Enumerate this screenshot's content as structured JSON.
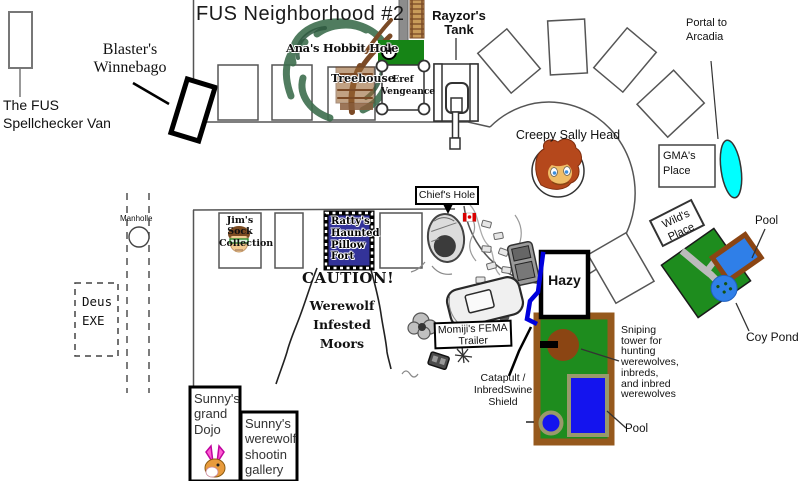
{
  "title": "FUS Neighborhood #2",
  "labels": {
    "spellchecker_van": "The FUS\nSpellchecker Van",
    "blasters_winnebago": "Blaster's\nWinnebago",
    "anas_hobbit_hole": "Ana's Hobbit Hole",
    "treehouse": "Treehouse",
    "helipad_h": "H",
    "eref_vengeance": "Eref\nVengeance",
    "rayzors_tank": "Rayzor's\nTank",
    "portal_to_arcadia": "Portal to\nArcadia",
    "creepy_sally_head": "Creepy Sally Head",
    "gmas_place": "GMA's\nPlace",
    "wilds_place": "Wild's\nPlace",
    "pool_upper": "Pool",
    "coy_pond": "Coy Pond",
    "manholle": "Manholle",
    "deus_exe": "Deus\nEXE",
    "jims_sock_collection": "Jim's Sock\nCollection",
    "rattys_pillow_fort": "Ratty's\nHaunted\nPillow\nFort",
    "chiefs_hole": "Chief's Hole",
    "caution": "CAUTION!",
    "werewolf_moors": "Werewolf\nInfested\nMoors",
    "hazy": "Hazy",
    "momijis_fema_trailer": "Momiji's FEMA\nTrailer",
    "catapult_shield": "Catapult /\nInbredSwine\nShield",
    "sniping_tower": "Sniping\ntower for\nhunting\nwerewolves,\ninbreds,\nand inbred\nwerewolves",
    "pool_lower": "Pool",
    "sunnys_dojo": "Sunny's\ngrand\nDojo",
    "sunnys_gallery": "Sunny's\nwerewolf\nshootin\ngallery"
  },
  "colors": {
    "portal_cyan": "#00FFFF",
    "helipad_green": "#168416",
    "yard_green": "#1E8C1E",
    "yard_border_brown": "#96591D",
    "pool_blue": "#1414EE",
    "pool_border_olive": "#99996B",
    "pond_blue": "#2F7FE8",
    "pond_pool_border_brown": "#8B4513",
    "pillow_fort_blue": "#333399",
    "flag_red": "#D90000",
    "tree_green": "#3E6E4E",
    "trunk_brown": "#7B4A26",
    "sniper_tower_brown": "#8B4513",
    "sally_hair": "#B5481C",
    "sally_face": "#F0BE68",
    "shield_blue": "#0000DD"
  }
}
